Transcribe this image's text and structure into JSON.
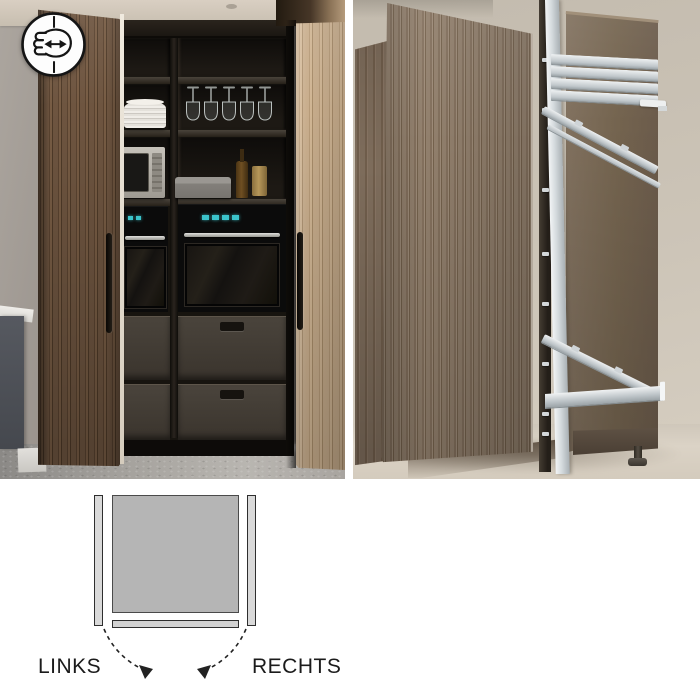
{
  "diagram": {
    "left_label": "LINKS",
    "right_label": "RECHTS"
  },
  "icon": {
    "name": "hand-slide-horizontal"
  },
  "colors": {
    "background": "#ffffff",
    "door_wood_dark": "#6b523c",
    "door_wood_light": "#c2a685",
    "mechanism_door_wood": "#8d7a68",
    "cabinet_side_brown": "#74644f",
    "rail_aluminum": "#d9dde0",
    "oven_display_teal": "#3bc3ca",
    "diagram_square_fill": "#b5b5b5",
    "diagram_bar_fill": "#d9d9d9",
    "diagram_outline": "#2e2e2e",
    "label_text": "#1b1b1b"
  }
}
